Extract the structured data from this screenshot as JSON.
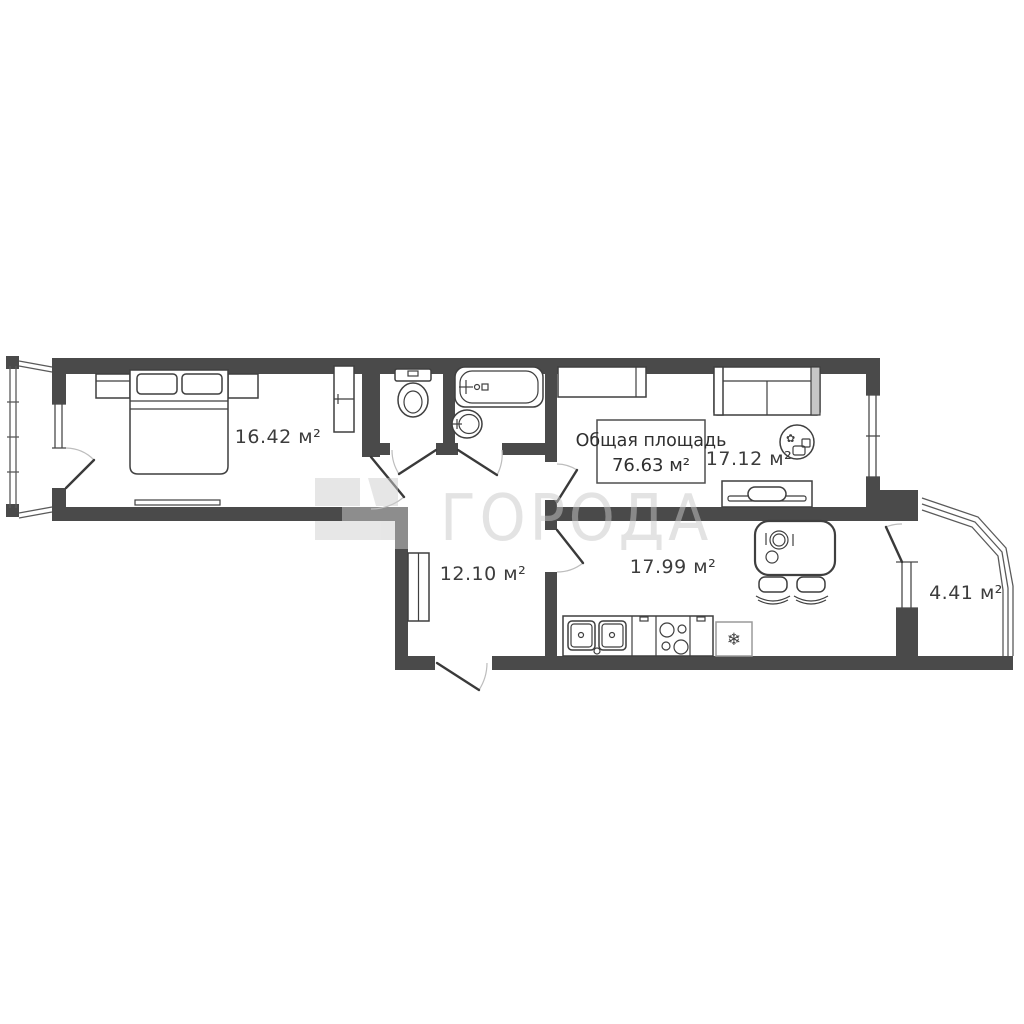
{
  "plan": {
    "watermark": {
      "text": "ГОРОДА"
    },
    "total_area": {
      "title": "Общая площадь",
      "value": "76.63 м²"
    },
    "rooms": {
      "bedroom": {
        "area": "16.42 м²"
      },
      "hall": {
        "area": "12.10 м²"
      },
      "kitchen": {
        "area": "17.99 м²"
      },
      "living_room": {
        "area": "17.12 м²"
      },
      "balcony": {
        "area": "4.41 м²"
      }
    },
    "icons": {
      "fridge": "❄",
      "plant": "✿"
    },
    "colors": {
      "wall": "#4a4a4a",
      "wall_shared": "#8d8d8d",
      "line": "#3f3f3f",
      "watermark": "#c9c9c9",
      "background": "#ffffff"
    }
  }
}
